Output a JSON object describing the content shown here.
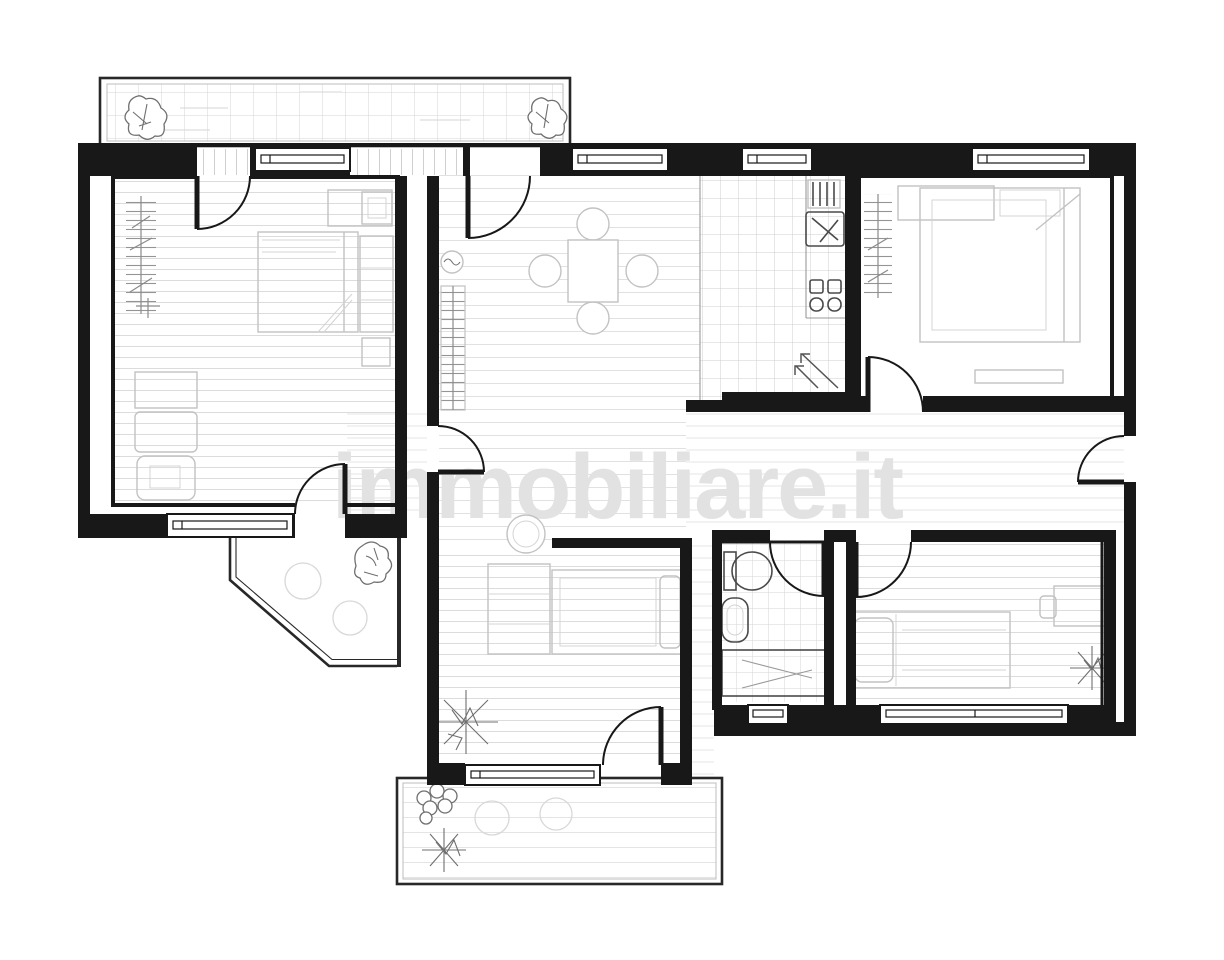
{
  "watermark": {
    "text": "immobiliare.it"
  },
  "colors": {
    "paper": "#ffffff",
    "wall": "#181818",
    "furn": "#c2c2c2",
    "fixture": "#4a4a4a",
    "plant": "#6f6f6f",
    "watermark": "#e2e2e2"
  },
  "plan": {
    "type": "apartment-floor-plan",
    "drawing_style": "monochrome top-down architectural line drawing",
    "rooms": [
      {
        "name": "bedroom-left",
        "features": [
          "double-bed",
          "wardrobe-hatch",
          "dressers",
          "balcony-door",
          "hallway-door",
          "window-top",
          "window-bottom"
        ]
      },
      {
        "name": "living-dining-room",
        "features": [
          "square-dining-table",
          "four-round-chairs",
          "shelf-unit",
          "small-plant",
          "balcony-door",
          "two-windows"
        ]
      },
      {
        "name": "kitchen-area",
        "features": [
          "tiled-floor",
          "sink",
          "four-burner-stove",
          "drying-rack",
          "counter",
          "entry-arrows"
        ]
      },
      {
        "name": "bedroom-top-right",
        "features": [
          "double-bed",
          "wardrobe-hatch",
          "window",
          "door-to-hallway"
        ]
      },
      {
        "name": "hallway",
        "features": [
          "entrance-door-right",
          "doors-to-all-rooms"
        ]
      },
      {
        "name": "bathroom",
        "features": [
          "toilet",
          "bidet",
          "bathtub",
          "tiled-floor",
          "small-window"
        ]
      },
      {
        "name": "bedroom-bottom-right",
        "features": [
          "single-bed",
          "desk",
          "spiky-plant",
          "window"
        ]
      },
      {
        "name": "room-bottom-center",
        "features": [
          "round-table",
          "bookcase",
          "sofa-bed",
          "large-spiky-plant",
          "window",
          "balcony-door"
        ]
      }
    ],
    "balconies": [
      {
        "name": "balcony-top",
        "features": [
          "tiled-floor",
          "plant-left",
          "plant-right"
        ]
      },
      {
        "name": "balcony-left",
        "features": [
          "chamfered-railing",
          "plant",
          "two-round-tables"
        ]
      },
      {
        "name": "balcony-bottom",
        "features": [
          "railing",
          "bushy-plant",
          "spiky-plant",
          "two-round-chairs"
        ]
      }
    ]
  }
}
